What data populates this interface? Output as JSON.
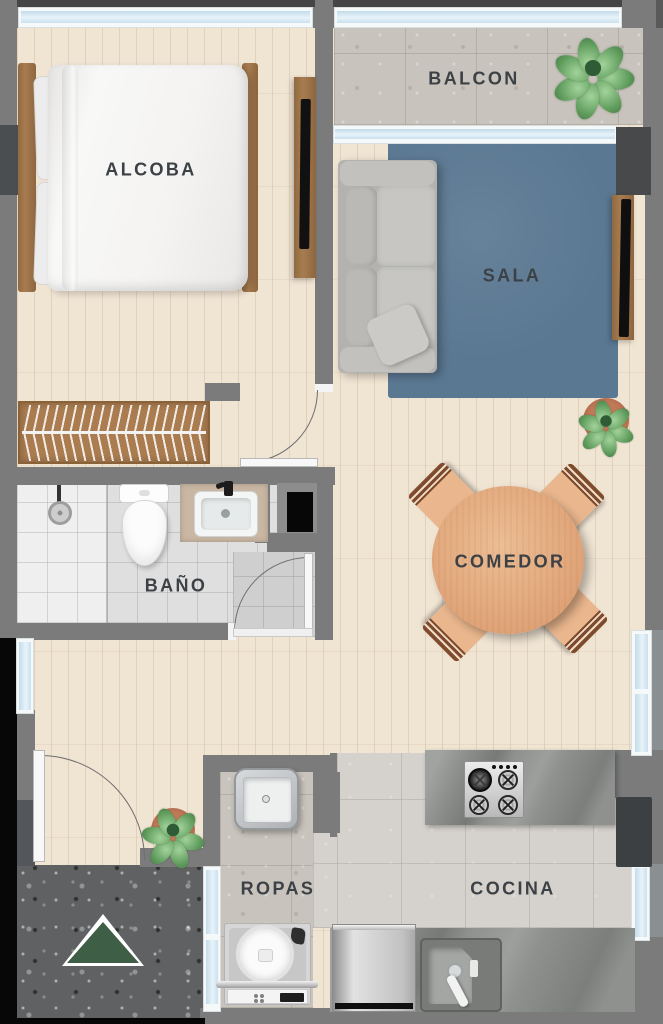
{
  "title": "Apartment floor plan",
  "rooms": [
    {
      "id": "alcoba",
      "label": "ALCOBA"
    },
    {
      "id": "balcon",
      "label": "BALCON"
    },
    {
      "id": "sala",
      "label": "SALA"
    },
    {
      "id": "bano",
      "label": "BAÑO"
    },
    {
      "id": "comedor",
      "label": "COMEDOR"
    },
    {
      "id": "ropas",
      "label": "ROPAS"
    },
    {
      "id": "cocina",
      "label": "COCINA"
    }
  ],
  "fixtures": [
    "bed",
    "wardrobe",
    "tv-console",
    "sofa",
    "rug",
    "dining-table",
    "dining-chairs",
    "toilet",
    "vanity-sink",
    "shower",
    "washing-machine",
    "laundry-sink",
    "stove",
    "dishwasher",
    "kitchen-sink",
    "refrigerator",
    "plants",
    "entrance-marker"
  ],
  "colors": {
    "wall": "#7b7b7b",
    "wood_floor": "#f0e4d3",
    "bath_tile": "#dfdfdf",
    "concrete": "#c8c3bc",
    "kitchen_floor": "#d5d1cc",
    "terrazzo": "#5f6162",
    "rug": "#5b7892",
    "window_glass": "#cfe4ef",
    "furniture_wood": "#a0744a",
    "table_wood": "#e5ad83",
    "label_text": "#3c4146",
    "entrance_triangle": "#3f5e46"
  }
}
